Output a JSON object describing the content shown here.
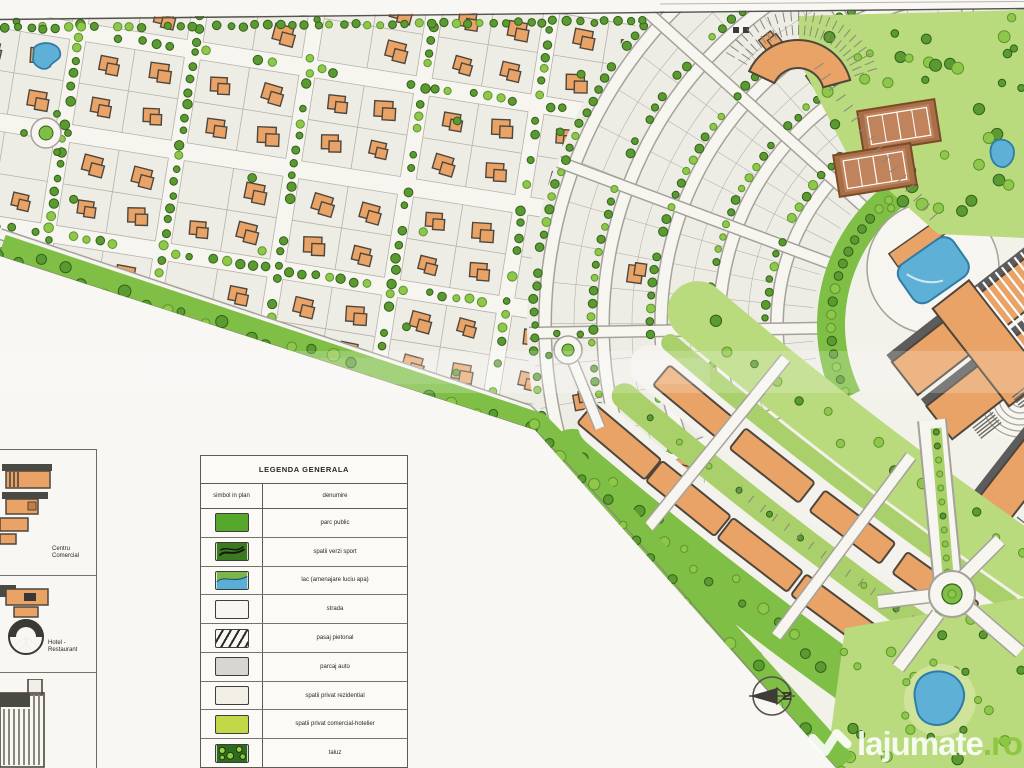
{
  "legend": {
    "title": "LEGENDA GENERALA",
    "columns": [
      "simbol in plan",
      "denumire"
    ],
    "rows": [
      {
        "id": "parc-public",
        "label": "parc public"
      },
      {
        "id": "spatii-verzi-sport",
        "label": "spatii verzi sport"
      },
      {
        "id": "lac",
        "label": "lac (amenajare luciu apa)"
      },
      {
        "id": "strada",
        "label": "strada"
      },
      {
        "id": "pasaj-pietonal",
        "label": "pasaj pietonal"
      },
      {
        "id": "parcaj-auto",
        "label": "parcaj auto"
      },
      {
        "id": "spatii-privat-rezidential",
        "label": "spatii privat rezidential"
      },
      {
        "id": "spatii-privat-comercial",
        "label": "spatii privat comercial-hotelier"
      },
      {
        "id": "taluz",
        "label": "taluz"
      }
    ]
  },
  "side_panel": {
    "items": [
      {
        "label": "Centru Comercial"
      },
      {
        "label": "Hotel - Restaurant"
      },
      {
        "label": ""
      }
    ]
  },
  "compass": {
    "label": "N"
  },
  "watermark": {
    "name": "lajumate",
    "tld": ".ro"
  },
  "map": {
    "colors": {
      "paper": "#f8f7f3",
      "plan_bg": "#f2f1ea",
      "road": "#f6f5f0",
      "road_edge": "#a5a29a",
      "plot": "#eeede5",
      "plot_edge": "#b5b2a8",
      "house": "#e9a366",
      "house_edge": "#4e463d",
      "tree_dark": "#5a9a31",
      "tree_dark_edge": "#33611a",
      "tree_light": "#8fc74a",
      "tree_light_edge": "#5d9430",
      "park": "#b9da7d",
      "green_belt": "#7fbf45",
      "green_median": "#a9d06a",
      "lawn": "#cfe49a",
      "water": "#5fb0d6",
      "water_edge": "#2e7da6",
      "court": "#a86f48",
      "court_inner": "#c0835c",
      "roof": "#5c5c5c",
      "line": "#55524d",
      "legend_parc": "#55a82c",
      "legend_sport": "#3c7a20",
      "legend_comercial": "#c3d748",
      "watermark_green": "#8dc63f"
    }
  }
}
